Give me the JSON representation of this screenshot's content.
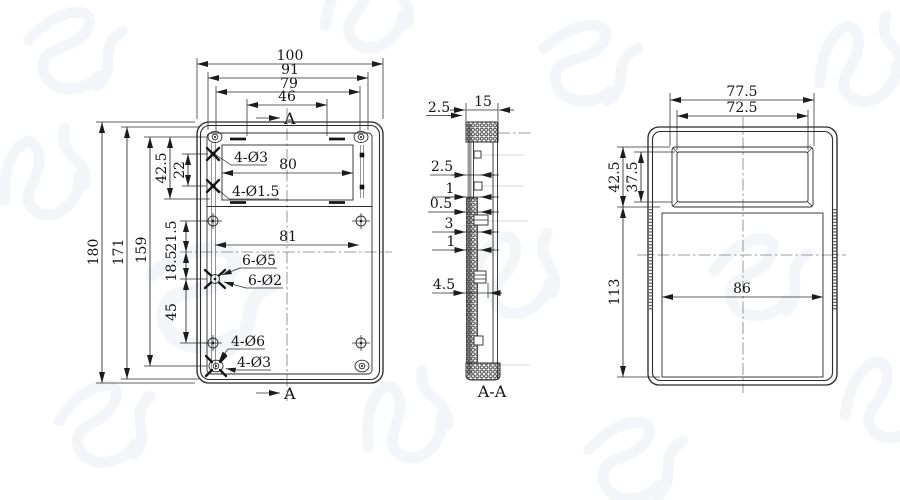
{
  "meta": {
    "type": "engineering-drawing-3-views",
    "background_color": "#ffffff",
    "line_color": "#2b2b2b",
    "centerline_color": "#7d7d7d",
    "section_edge_color": "#9a9a9a",
    "watermark_color": "#f2f4f9"
  },
  "front_view": {
    "section_marker_top": "A",
    "section_marker_bottom": "A",
    "dim_overall_width": "100",
    "dim_boss_width": "91",
    "dim_hole_width": "79",
    "dim_slot_width": "46",
    "dim_overall_height": "180",
    "dim_inner_height": "171",
    "dim_boss_height": "159",
    "dim_window_offset": "42.5",
    "dim_pad_spacing": "22",
    "dim_mid_upper": "21.5",
    "dim_mid_lower": "18.5",
    "dim_lower_span": "45",
    "dim_window_width": "80",
    "dim_hole_span": "81",
    "label_corner_holes": "4-Ø3",
    "label_small_holes": "4-Ø1.5",
    "label_mid_boss_od": "6-Ø5",
    "label_mid_boss_id": "6-Ø2",
    "label_bottom_holes": "4-Ø6",
    "label_bottom_boss": "4-Ø3"
  },
  "section_view": {
    "title": "A-A",
    "dim_depth": "15",
    "dim_top_wall": "2.5",
    "dim_step_1": "2.5",
    "dim_step_2": "1",
    "dim_step_3": "0.5",
    "dim_step_4": "3",
    "dim_step_5": "1",
    "dim_boss_depth": "4.5"
  },
  "side_view": {
    "dim_window_outer_width": "77.5",
    "dim_window_inner_width": "72.5",
    "dim_window_outer_height": "42.5",
    "dim_window_inner_height": "37.5",
    "dim_body_height": "113",
    "dim_panel_width": "86"
  }
}
